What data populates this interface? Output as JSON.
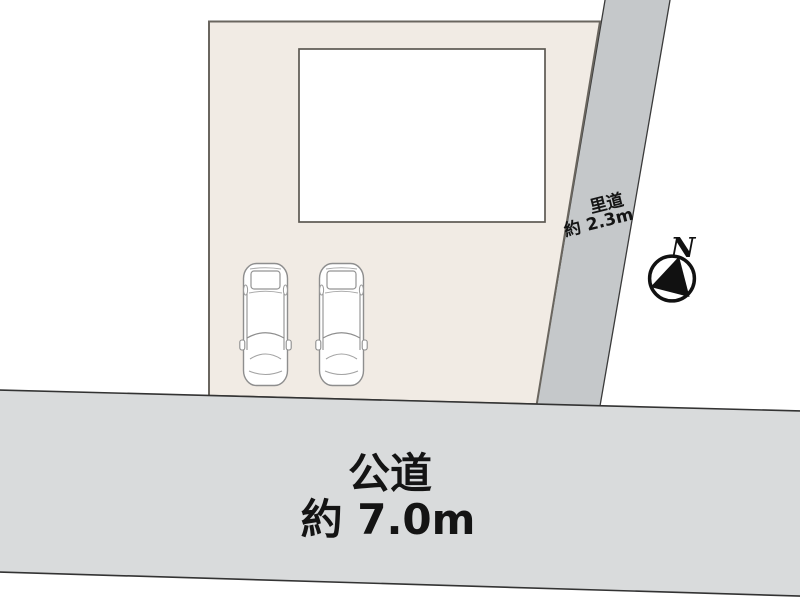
{
  "figure": {
    "kind": "site-plan",
    "background_color": "#ffffff",
    "parcel": {
      "fill": "#f1ebe4",
      "stroke": "#6a665f"
    },
    "building": {
      "fill": "#ffffff",
      "stroke": "#5d5952"
    },
    "main_road": {
      "name": "公道",
      "width_label": "約 7.0m",
      "fill": "#d9dbdc",
      "stroke": "#333333"
    },
    "side_road": {
      "name": "里道",
      "width_label": "約 2.3m",
      "fill": "#c5c8ca",
      "stroke": "#3a3a3a"
    },
    "compass": {
      "north_label": "N"
    },
    "cars": {
      "count": 2,
      "outline_color": "#8e8e8e"
    }
  }
}
